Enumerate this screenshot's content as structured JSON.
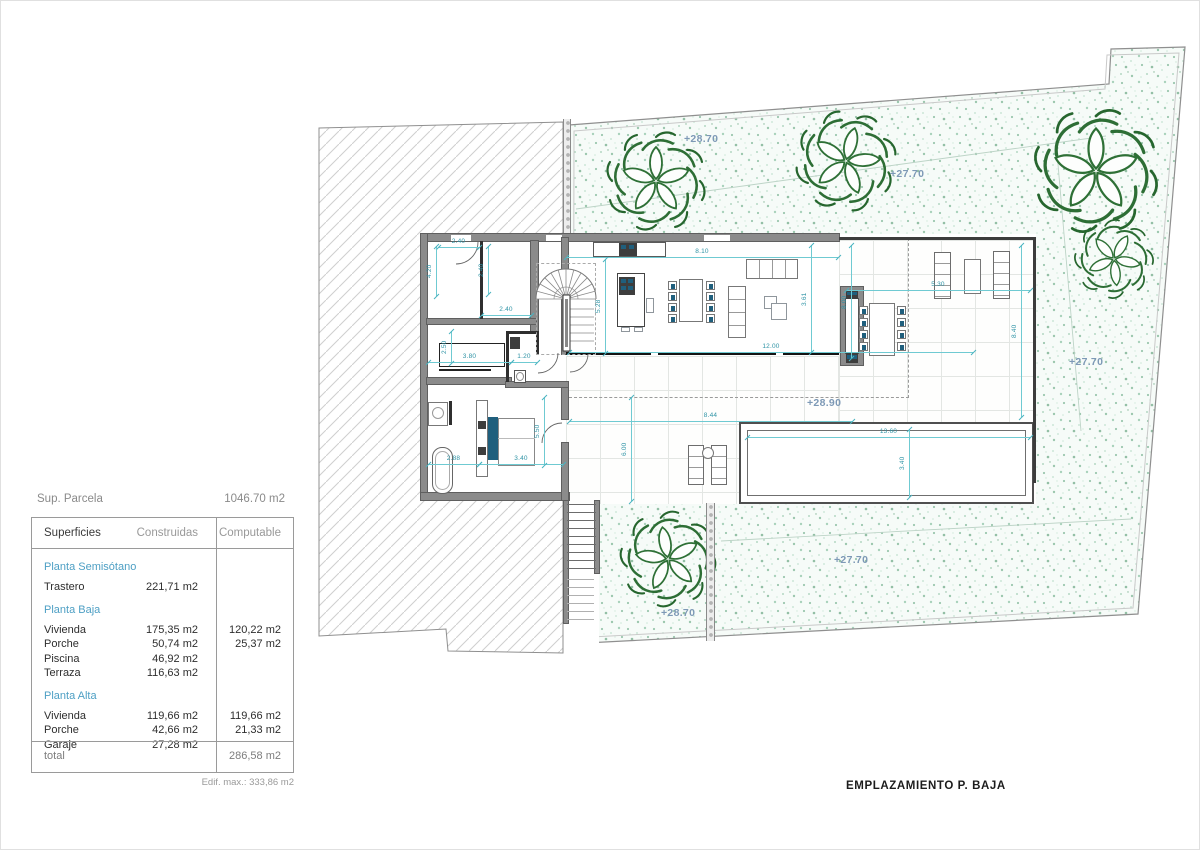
{
  "panel": {
    "parcel_label": "Sup. Parcela",
    "parcel_value": "1046.70 m2",
    "table": {
      "headers": [
        "Superficies",
        "Construidas",
        "Computable"
      ],
      "sections": [
        {
          "title": "Planta Semisótano",
          "rows": [
            {
              "name": "Trastero",
              "construida": "221,71 m2",
              "computable": ""
            }
          ]
        },
        {
          "title": "Planta Baja",
          "rows": [
            {
              "name": "Vivienda",
              "construida": "175,35 m2",
              "computable": "120,22 m2"
            },
            {
              "name": "Porche",
              "construida": "50,74 m2",
              "computable": "25,37 m2"
            },
            {
              "name": "Piscina",
              "construida": "46,92 m2",
              "computable": ""
            },
            {
              "name": "Terraza",
              "construida": "116,63 m2",
              "computable": ""
            }
          ]
        },
        {
          "title": "Planta Alta",
          "rows": [
            {
              "name": "Vivienda",
              "construida": "119,66 m2",
              "computable": "119,66 m2"
            },
            {
              "name": "Porche",
              "construida": "42,66 m2",
              "computable": "21,33 m2"
            },
            {
              "name": "Garaje",
              "construida": "27,28 m2",
              "computable": ""
            }
          ]
        }
      ],
      "total_label": "total",
      "total_value": "286,58 m2",
      "note": "Edif. max.: 333,86 m2"
    }
  },
  "caption": "EMPLAZAMIENTO P. BAJA",
  "elevations": [
    {
      "t": "+28.70",
      "x": 683,
      "y": 132
    },
    {
      "t": "+27.70",
      "x": 889,
      "y": 167
    },
    {
      "t": "+27.70",
      "x": 1068,
      "y": 355
    },
    {
      "t": "+28.90",
      "x": 806,
      "y": 396
    },
    {
      "t": "+28.70",
      "x": 660,
      "y": 606
    },
    {
      "t": "+27.70",
      "x": 833,
      "y": 553
    }
  ],
  "dims": [
    {
      "o": "h",
      "x": 437,
      "y": 246,
      "len": 41,
      "t": "2.40"
    },
    {
      "o": "h",
      "x": 480,
      "y": 314,
      "len": 50,
      "t": "2.40"
    },
    {
      "o": "h",
      "x": 427,
      "y": 361,
      "len": 83,
      "t": "3.80"
    },
    {
      "o": "h",
      "x": 510,
      "y": 361,
      "len": 26,
      "t": "1.20"
    },
    {
      "o": "h",
      "x": 565,
      "y": 256,
      "len": 272,
      "t": "8.10"
    },
    {
      "o": "h",
      "x": 568,
      "y": 351,
      "len": 404,
      "t": "12.00"
    },
    {
      "o": "h",
      "x": 427,
      "y": 463,
      "len": 51,
      "t": "2.88"
    },
    {
      "o": "h",
      "x": 478,
      "y": 463,
      "len": 84,
      "t": "3.40"
    },
    {
      "o": "h",
      "x": 568,
      "y": 420,
      "len": 283,
      "t": "8.44"
    },
    {
      "o": "h",
      "x": 746,
      "y": 436,
      "len": 283,
      "t": "13.60"
    },
    {
      "o": "h",
      "x": 845,
      "y": 289,
      "len": 184,
      "t": "5.30"
    },
    {
      "o": "v",
      "x": 435,
      "y": 245,
      "len": 50,
      "t": "4.20"
    },
    {
      "o": "v",
      "x": 487,
      "y": 245,
      "len": 48,
      "t": "2.40"
    },
    {
      "o": "v",
      "x": 450,
      "y": 330,
      "len": 32,
      "t": "2.50"
    },
    {
      "o": "v",
      "x": 604,
      "y": 258,
      "len": 94,
      "t": "5.28"
    },
    {
      "o": "v",
      "x": 543,
      "y": 396,
      "len": 68,
      "t": "5.50"
    },
    {
      "o": "v",
      "x": 630,
      "y": 396,
      "len": 104,
      "t": "6.00"
    },
    {
      "o": "v",
      "x": 908,
      "y": 428,
      "len": 68,
      "t": "3.40"
    },
    {
      "o": "v",
      "x": 1020,
      "y": 244,
      "len": 172,
      "t": "8.40"
    },
    {
      "o": "v",
      "x": 810,
      "y": 244,
      "len": 107,
      "t": "3.61"
    },
    {
      "o": "v",
      "x": 850,
      "y": 244,
      "len": 113,
      "t": "8.00"
    }
  ],
  "colors": {
    "dim_line": "#6fcad2",
    "dim_text": "#2e93a5",
    "elevation_text": "#7d99b6",
    "plant_green": "#2d6e35",
    "accent_teal": "#1f5f7d",
    "section_title_blue": "#4d9fc4",
    "garden_bg": "#f6fbf8",
    "wall_gray": "#8b8b8b"
  }
}
